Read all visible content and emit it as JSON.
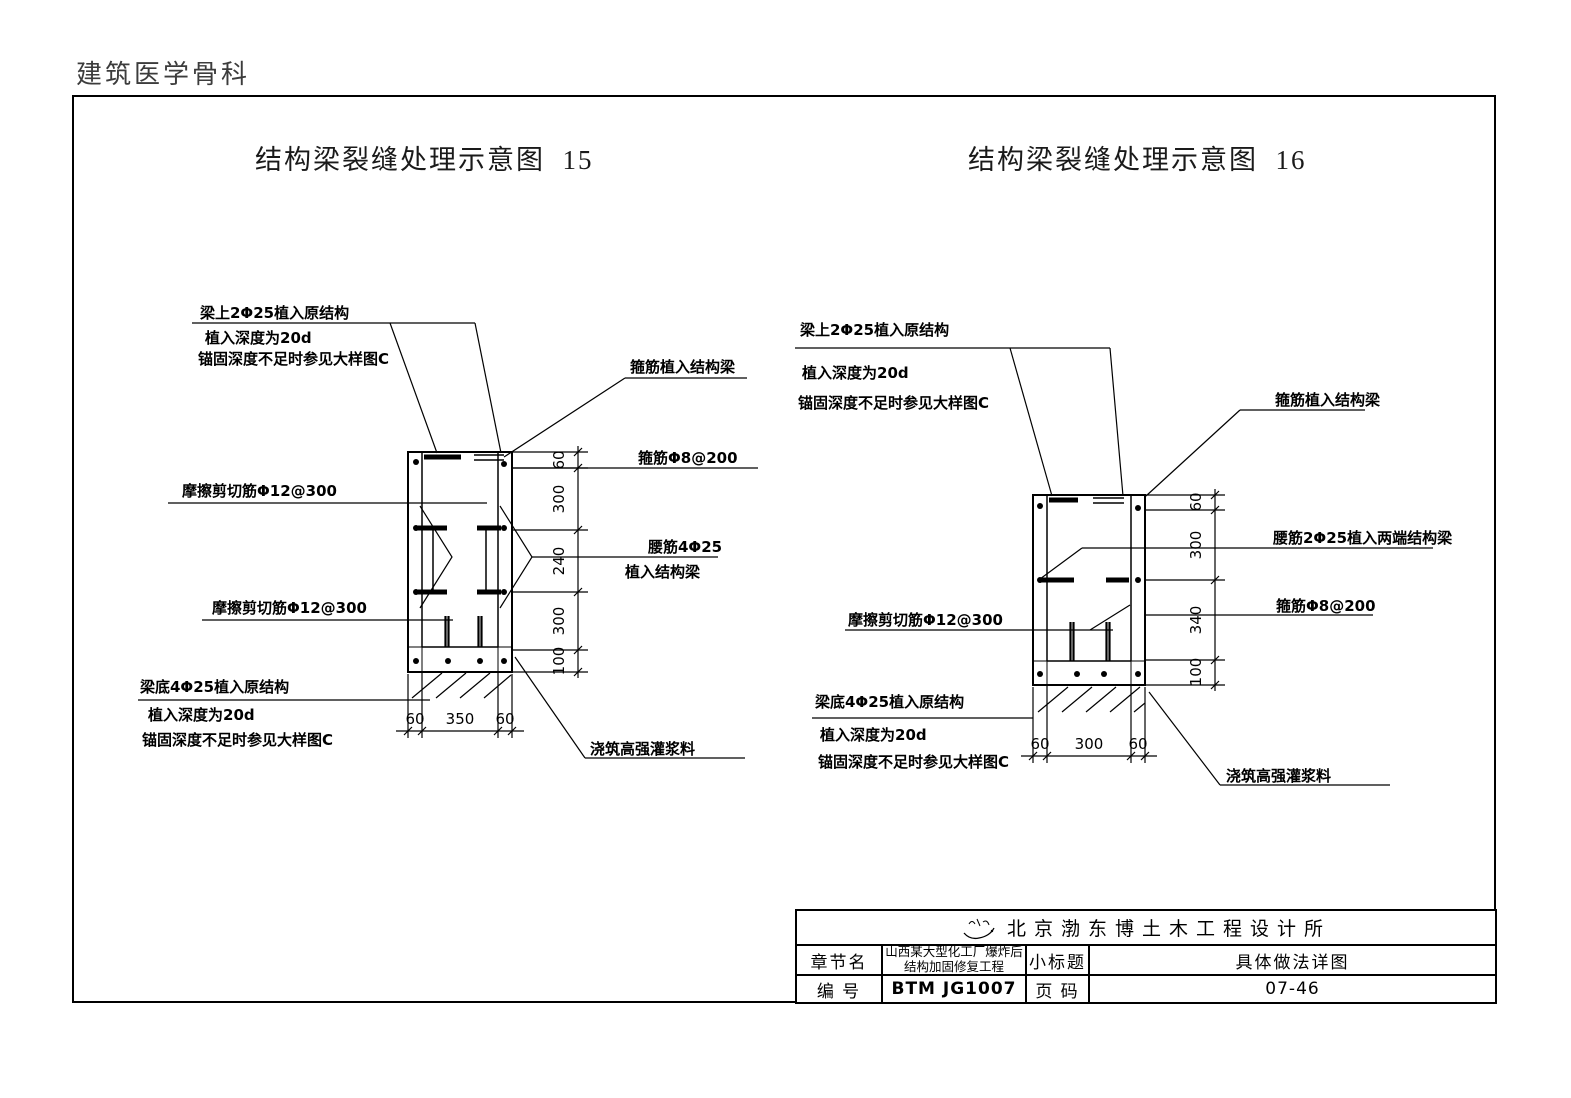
{
  "page": {
    "header": "建筑医学骨科"
  },
  "colors": {
    "line": "#000000",
    "background": "#ffffff",
    "header_text": "#3c3c3c"
  },
  "diagram15": {
    "title": "结构梁裂缝处理示意图  15",
    "labels": {
      "top1": "梁上2Φ25植入原结构",
      "top2": "植入深度为20d",
      "top3": "锚固深度不足时参见大样图C",
      "stirrup_embed": "箍筋植入结构梁",
      "stirrup_spec": "箍筋Φ8@200",
      "friction_upper": "摩擦剪切筋Φ12@300",
      "waist1": "腰筋4Φ25",
      "waist2": "植入结构梁",
      "friction_lower": "摩擦剪切筋Φ12@300",
      "bottom1": "梁底4Φ25植入原结构",
      "bottom2": "植入深度为20d",
      "bottom3": "锚固深度不足时参见大样图C",
      "grout": "浇筑高强灌浆料"
    },
    "dims_v": [
      "60",
      "300",
      "240",
      "300",
      "100"
    ],
    "dims_h": [
      "60",
      "350",
      "60"
    ]
  },
  "diagram16": {
    "title": "结构梁裂缝处理示意图  16",
    "labels": {
      "top1": "梁上2Φ25植入原结构",
      "top2": "植入深度为20d",
      "top3": "锚固深度不足时参见大样图C",
      "stirrup_embed": "箍筋植入结构梁",
      "waist": "腰筋2Φ25植入两端结构梁",
      "stirrup_spec": "箍筋Φ8@200",
      "friction": "摩擦剪切筋Φ12@300",
      "bottom1": "梁底4Φ25植入原结构",
      "bottom2": "植入深度为20d",
      "bottom3": "锚固深度不足时参见大样图C",
      "grout": "浇筑高强灌浆料"
    },
    "dims_v": [
      "60",
      "300",
      "340",
      "100"
    ],
    "dims_h": [
      "60",
      "300",
      "60"
    ]
  },
  "title_block": {
    "company": "北京渤东博土木工程设计所",
    "chapter_label": "章节名",
    "chapter_value_line1": "山西某大型化工厂爆炸后",
    "chapter_value_line2": "结构加固修复工程",
    "subtitle_label": "小标题",
    "subtitle_value": "具体做法详图",
    "number_label": "编  号",
    "number_value": "BTM JG1007",
    "page_label": "页  码",
    "page_value": "07-46"
  }
}
